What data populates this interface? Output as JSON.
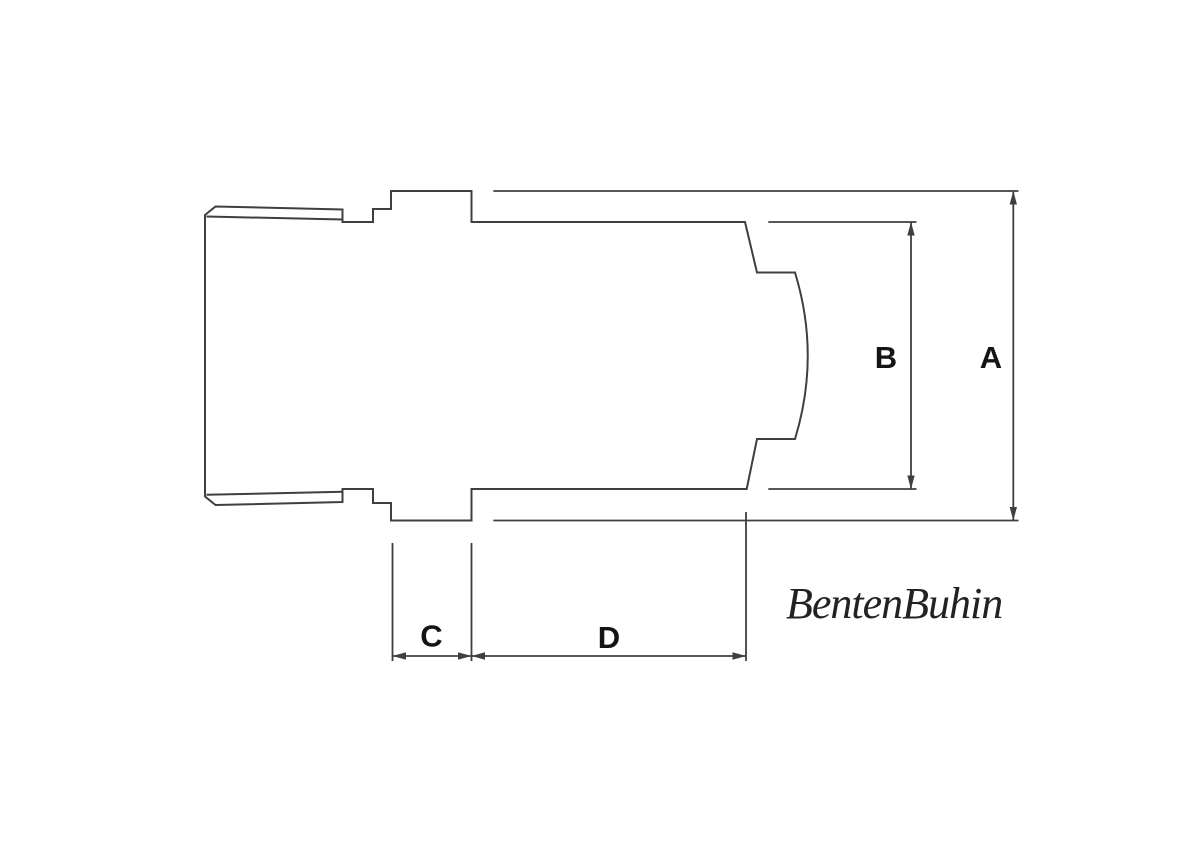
{
  "canvas": {
    "background": "#ffffff",
    "line_color": "#3f3f3f",
    "label_color": "#141414"
  },
  "drawing": {
    "kind": "technical-line-drawing",
    "subject": "fitting-side-profile"
  },
  "dimensions": {
    "a_label": "A",
    "b_label": "B",
    "c_label": "C",
    "d_label": "D"
  },
  "brand": {
    "wordmark": "BentenBuhin"
  }
}
